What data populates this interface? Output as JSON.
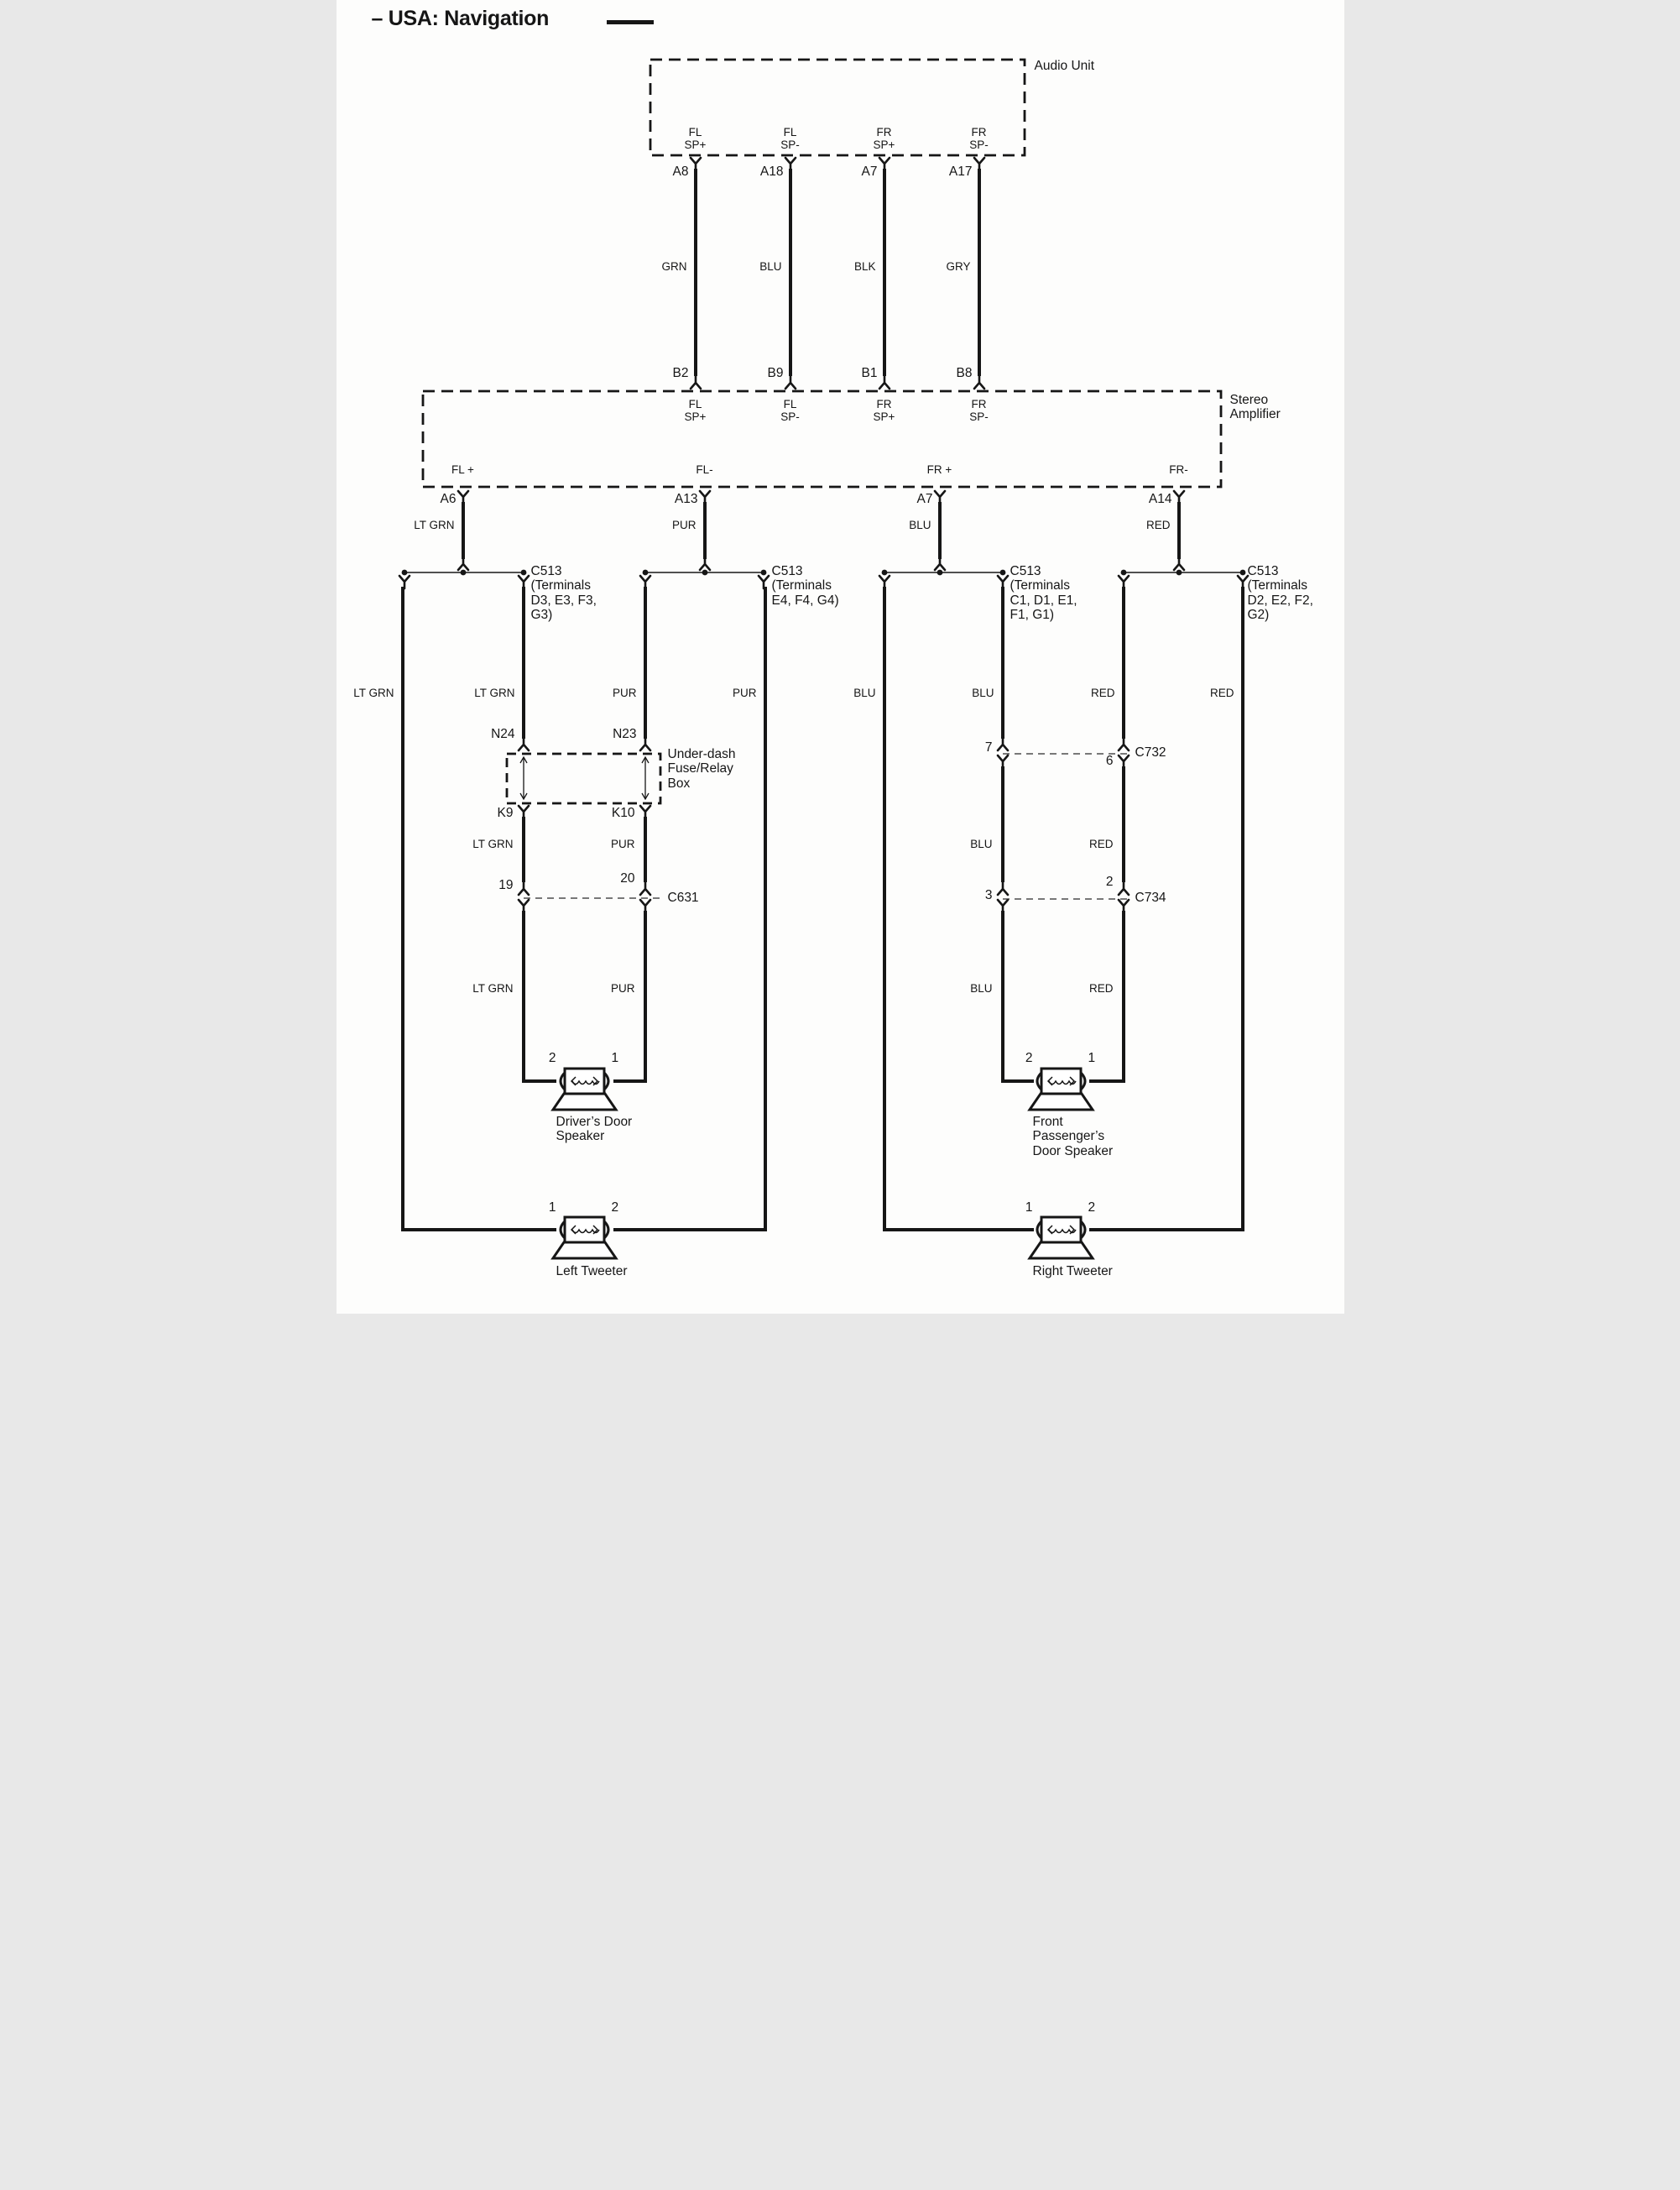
{
  "title": "– USA: Navigation",
  "audio_unit": {
    "name": "Audio Unit",
    "pins": [
      {
        "line1": "FL",
        "line2": "SP+",
        "terminal": "A8",
        "wire_color": "GRN"
      },
      {
        "line1": "FL",
        "line2": "SP-",
        "terminal": "A18",
        "wire_color": "BLU"
      },
      {
        "line1": "FR",
        "line2": "SP+",
        "terminal": "A7",
        "wire_color": "BLK"
      },
      {
        "line1": "FR",
        "line2": "SP-",
        "terminal": "A17",
        "wire_color": "GRY"
      }
    ]
  },
  "amplifier": {
    "name_line1": "Stereo",
    "name_line2": "Amplifier",
    "top_pins": [
      {
        "terminal": "B2",
        "line1": "FL",
        "line2": "SP+"
      },
      {
        "terminal": "B9",
        "line1": "FL",
        "line2": "SP-"
      },
      {
        "terminal": "B1",
        "line1": "FR",
        "line2": "SP+"
      },
      {
        "terminal": "B8",
        "line1": "FR",
        "line2": "SP-"
      }
    ],
    "bottom_pins": [
      {
        "name": "FL +",
        "terminal": "A6",
        "wire_color": "LT GRN"
      },
      {
        "name": "FL-",
        "terminal": "A13",
        "wire_color": "PUR"
      },
      {
        "name": "FR +",
        "terminal": "A7",
        "wire_color": "BLU"
      },
      {
        "name": "FR-",
        "terminal": "A14",
        "wire_color": "RED"
      }
    ]
  },
  "c513_groups": [
    {
      "id": "C513",
      "line1": "(Terminals",
      "line2": "D3, E3, F3,",
      "line3": "G3)"
    },
    {
      "id": "C513",
      "line1": "(Terminals",
      "line2": "E4, F4, G4)",
      "line3": ""
    },
    {
      "id": "C513",
      "line1": "(Terminals",
      "line2": "C1, D1, E1,",
      "line3": "F1, G1)"
    },
    {
      "id": "C513",
      "line1": "(Terminals",
      "line2": "D2, E2, F2,",
      "line3": "G2)"
    }
  ],
  "wire_labels": {
    "row1": [
      "LT GRN",
      "LT GRN",
      "PUR",
      "PUR",
      "BLU",
      "BLU",
      "RED",
      "RED"
    ],
    "row2": [
      "LT GRN",
      "PUR",
      "BLU",
      "RED"
    ],
    "row3": [
      "LT GRN",
      "PUR",
      "BLU",
      "RED"
    ]
  },
  "fuse_box": {
    "name_line1": "Under-dash",
    "name_line2": "Fuse/Relay",
    "name_line3": "Box",
    "top_left_terminal": "N24",
    "top_right_terminal": "N23",
    "bottom_left_terminal": "K9",
    "bottom_right_terminal": "K10"
  },
  "inline_connectors": [
    {
      "id": "C631",
      "left_pin": "19",
      "right_pin": "20"
    },
    {
      "id": "C732",
      "left_pin": "7",
      "right_pin": "6"
    },
    {
      "id": "C734",
      "left_pin": "3",
      "right_pin": "2"
    }
  ],
  "speakers": [
    {
      "name_line1": "Driver’s Door",
      "name_line2": "Speaker",
      "name_line3": "",
      "left_pin": "2",
      "right_pin": "1"
    },
    {
      "name_line1": "Front",
      "name_line2": "Passenger’s",
      "name_line3": "Door Speaker",
      "left_pin": "2",
      "right_pin": "1"
    },
    {
      "name_line1": "Left Tweeter",
      "name_line2": "",
      "name_line3": "",
      "left_pin": "1",
      "right_pin": "2"
    },
    {
      "name_line1": "Right Tweeter",
      "name_line2": "",
      "name_line3": "",
      "left_pin": "1",
      "right_pin": "2"
    }
  ]
}
